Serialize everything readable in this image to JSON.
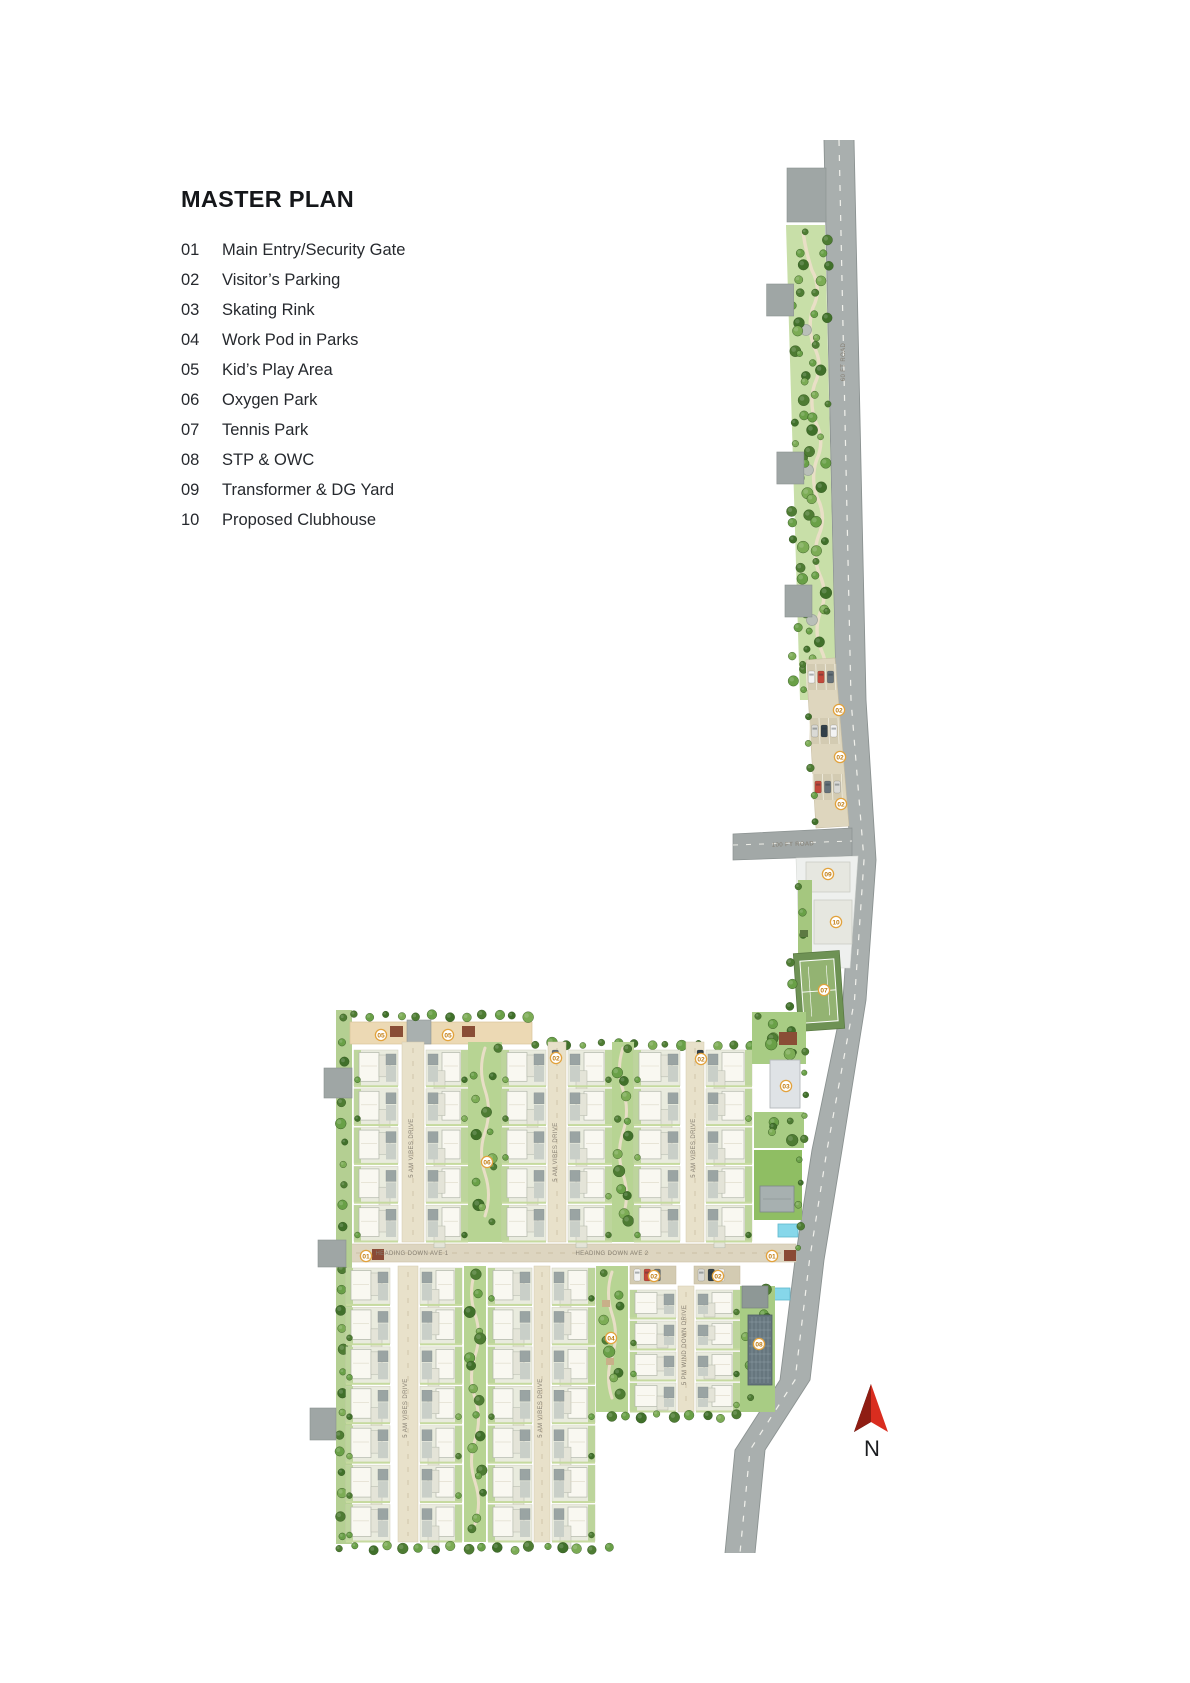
{
  "title": "MASTER PLAN",
  "legend": [
    {
      "num": "01",
      "label": "Main Entry/Security Gate"
    },
    {
      "num": "02",
      "label": "Visitor’s Parking"
    },
    {
      "num": "03",
      "label": "Skating Rink"
    },
    {
      "num": "04",
      "label": "Work Pod in Parks"
    },
    {
      "num": "05",
      "label": "Kid’s Play Area"
    },
    {
      "num": "06",
      "label": "Oxygen Park"
    },
    {
      "num": "07",
      "label": "Tennis Park"
    },
    {
      "num": "08",
      "label": "STP & OWC"
    },
    {
      "num": "09",
      "label": "Transformer & DG Yard"
    },
    {
      "num": "10",
      "label": "Proposed Clubhouse"
    }
  ],
  "compass": {
    "label": "N"
  },
  "map": {
    "marker_style": {
      "fill": "#ffffff",
      "ring": "#e2a23c",
      "text_color": "#c07c12"
    },
    "markers": [
      {
        "num": "02",
        "x": 839,
        "y": 710
      },
      {
        "num": "02",
        "x": 840,
        "y": 757
      },
      {
        "num": "02",
        "x": 841,
        "y": 804
      },
      {
        "num": "09",
        "x": 828,
        "y": 874
      },
      {
        "num": "10",
        "x": 836,
        "y": 922
      },
      {
        "num": "07",
        "x": 824,
        "y": 990
      },
      {
        "num": "05",
        "x": 381,
        "y": 1035
      },
      {
        "num": "05",
        "x": 448,
        "y": 1035
      },
      {
        "num": "02",
        "x": 556,
        "y": 1058
      },
      {
        "num": "02",
        "x": 701,
        "y": 1059
      },
      {
        "num": "03",
        "x": 786,
        "y": 1086
      },
      {
        "num": "06",
        "x": 487,
        "y": 1162
      },
      {
        "num": "01",
        "x": 366,
        "y": 1256
      },
      {
        "num": "01",
        "x": 772,
        "y": 1256
      },
      {
        "num": "02",
        "x": 654,
        "y": 1276
      },
      {
        "num": "02",
        "x": 718,
        "y": 1276
      },
      {
        "num": "04",
        "x": 611,
        "y": 1338
      },
      {
        "num": "08",
        "x": 759,
        "y": 1344
      }
    ],
    "street_labels": [
      {
        "text": "5 AM VIBES DRIVE",
        "x": 413,
        "y": 1148,
        "rot": -90
      },
      {
        "text": "5 AM VIBES DRIVE",
        "x": 557,
        "y": 1152,
        "rot": -90
      },
      {
        "text": "5 AM VIBES DRIVE",
        "x": 695,
        "y": 1148,
        "rot": -90
      },
      {
        "text": "5 AM VIBES DRIVE",
        "x": 407,
        "y": 1408,
        "rot": -90
      },
      {
        "text": "5 AM VIBES DRIVE",
        "x": 542,
        "y": 1408,
        "rot": -90
      },
      {
        "text": "5 PM WIND DOWN DRIVE",
        "x": 686,
        "y": 1345,
        "rot": -90
      },
      {
        "text": "HEADING DOWN AVE 1",
        "x": 412,
        "y": 1255,
        "rot": 0
      },
      {
        "text": "HEADING DOWN AVE 2",
        "x": 612,
        "y": 1255,
        "rot": 0
      },
      {
        "text": "100 FT ROAD",
        "x": 793,
        "y": 846,
        "rot": -2
      },
      {
        "text": "60 FT ROAD",
        "x": 845,
        "y": 362,
        "rot": -90
      }
    ]
  }
}
